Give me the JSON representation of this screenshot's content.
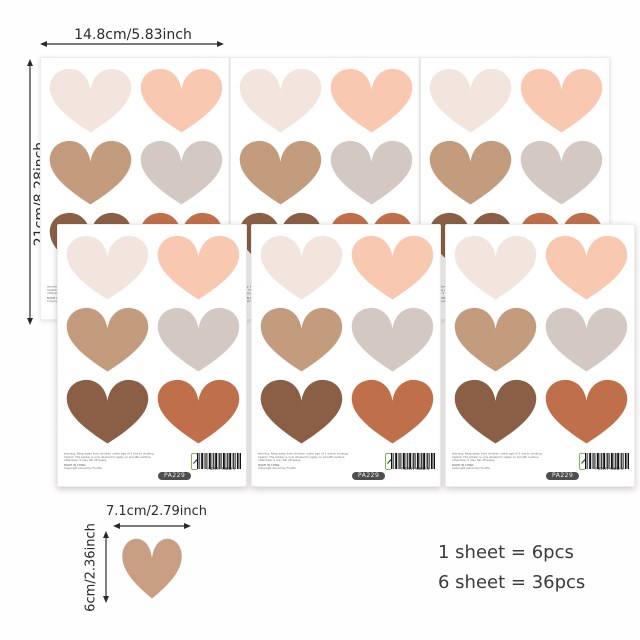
{
  "annotations": {
    "sheet_width_label": "14.8cm/5.83inch",
    "sheet_height_label": "21cm/8.28inch",
    "heart_width_label": "7.1cm/2.79inch",
    "heart_height_label": "6cm/2.36inch"
  },
  "pcs_info": {
    "line1": "1 sheet = 6pcs",
    "line2": "6 sheet = 36pcs"
  },
  "sheet": {
    "warning_line1": "warning: Keep away from children under age of 3 due to choking",
    "warning_line2": "hazard. The sticker is only allowed to apply on smooth surface,",
    "warning_line3": "otherwise, it may fall off easily.",
    "made_in": "MADE IN CHINA",
    "copyright": "Copyright owned by Funlife",
    "sku": "PA229",
    "brand_text": "unlife",
    "brand_reg": "®",
    "brand_tagline": "LIVING FOR LIFE",
    "barcode_digits": "7 62917 94642 4",
    "hearts": [
      {
        "name": "cream",
        "color": "#f1e5de"
      },
      {
        "name": "peach",
        "color": "#f8c8b1"
      },
      {
        "name": "camel",
        "color": "#c39c7e"
      },
      {
        "name": "greige",
        "color": "#d3c9c2"
      },
      {
        "name": "dark-brown",
        "color": "#8a5f45"
      },
      {
        "name": "terracotta",
        "color": "#c06f4b"
      }
    ]
  },
  "single_heart": {
    "name": "tan-heart",
    "color": "#c89f83"
  },
  "colors": {
    "annotation_text": "#2b2b2b",
    "logo_green": "#55a13c",
    "logo_border_green": "#7cb94e",
    "sku_pill_bg": "#4f4f4f",
    "sheet_bg": "#ffffff"
  }
}
